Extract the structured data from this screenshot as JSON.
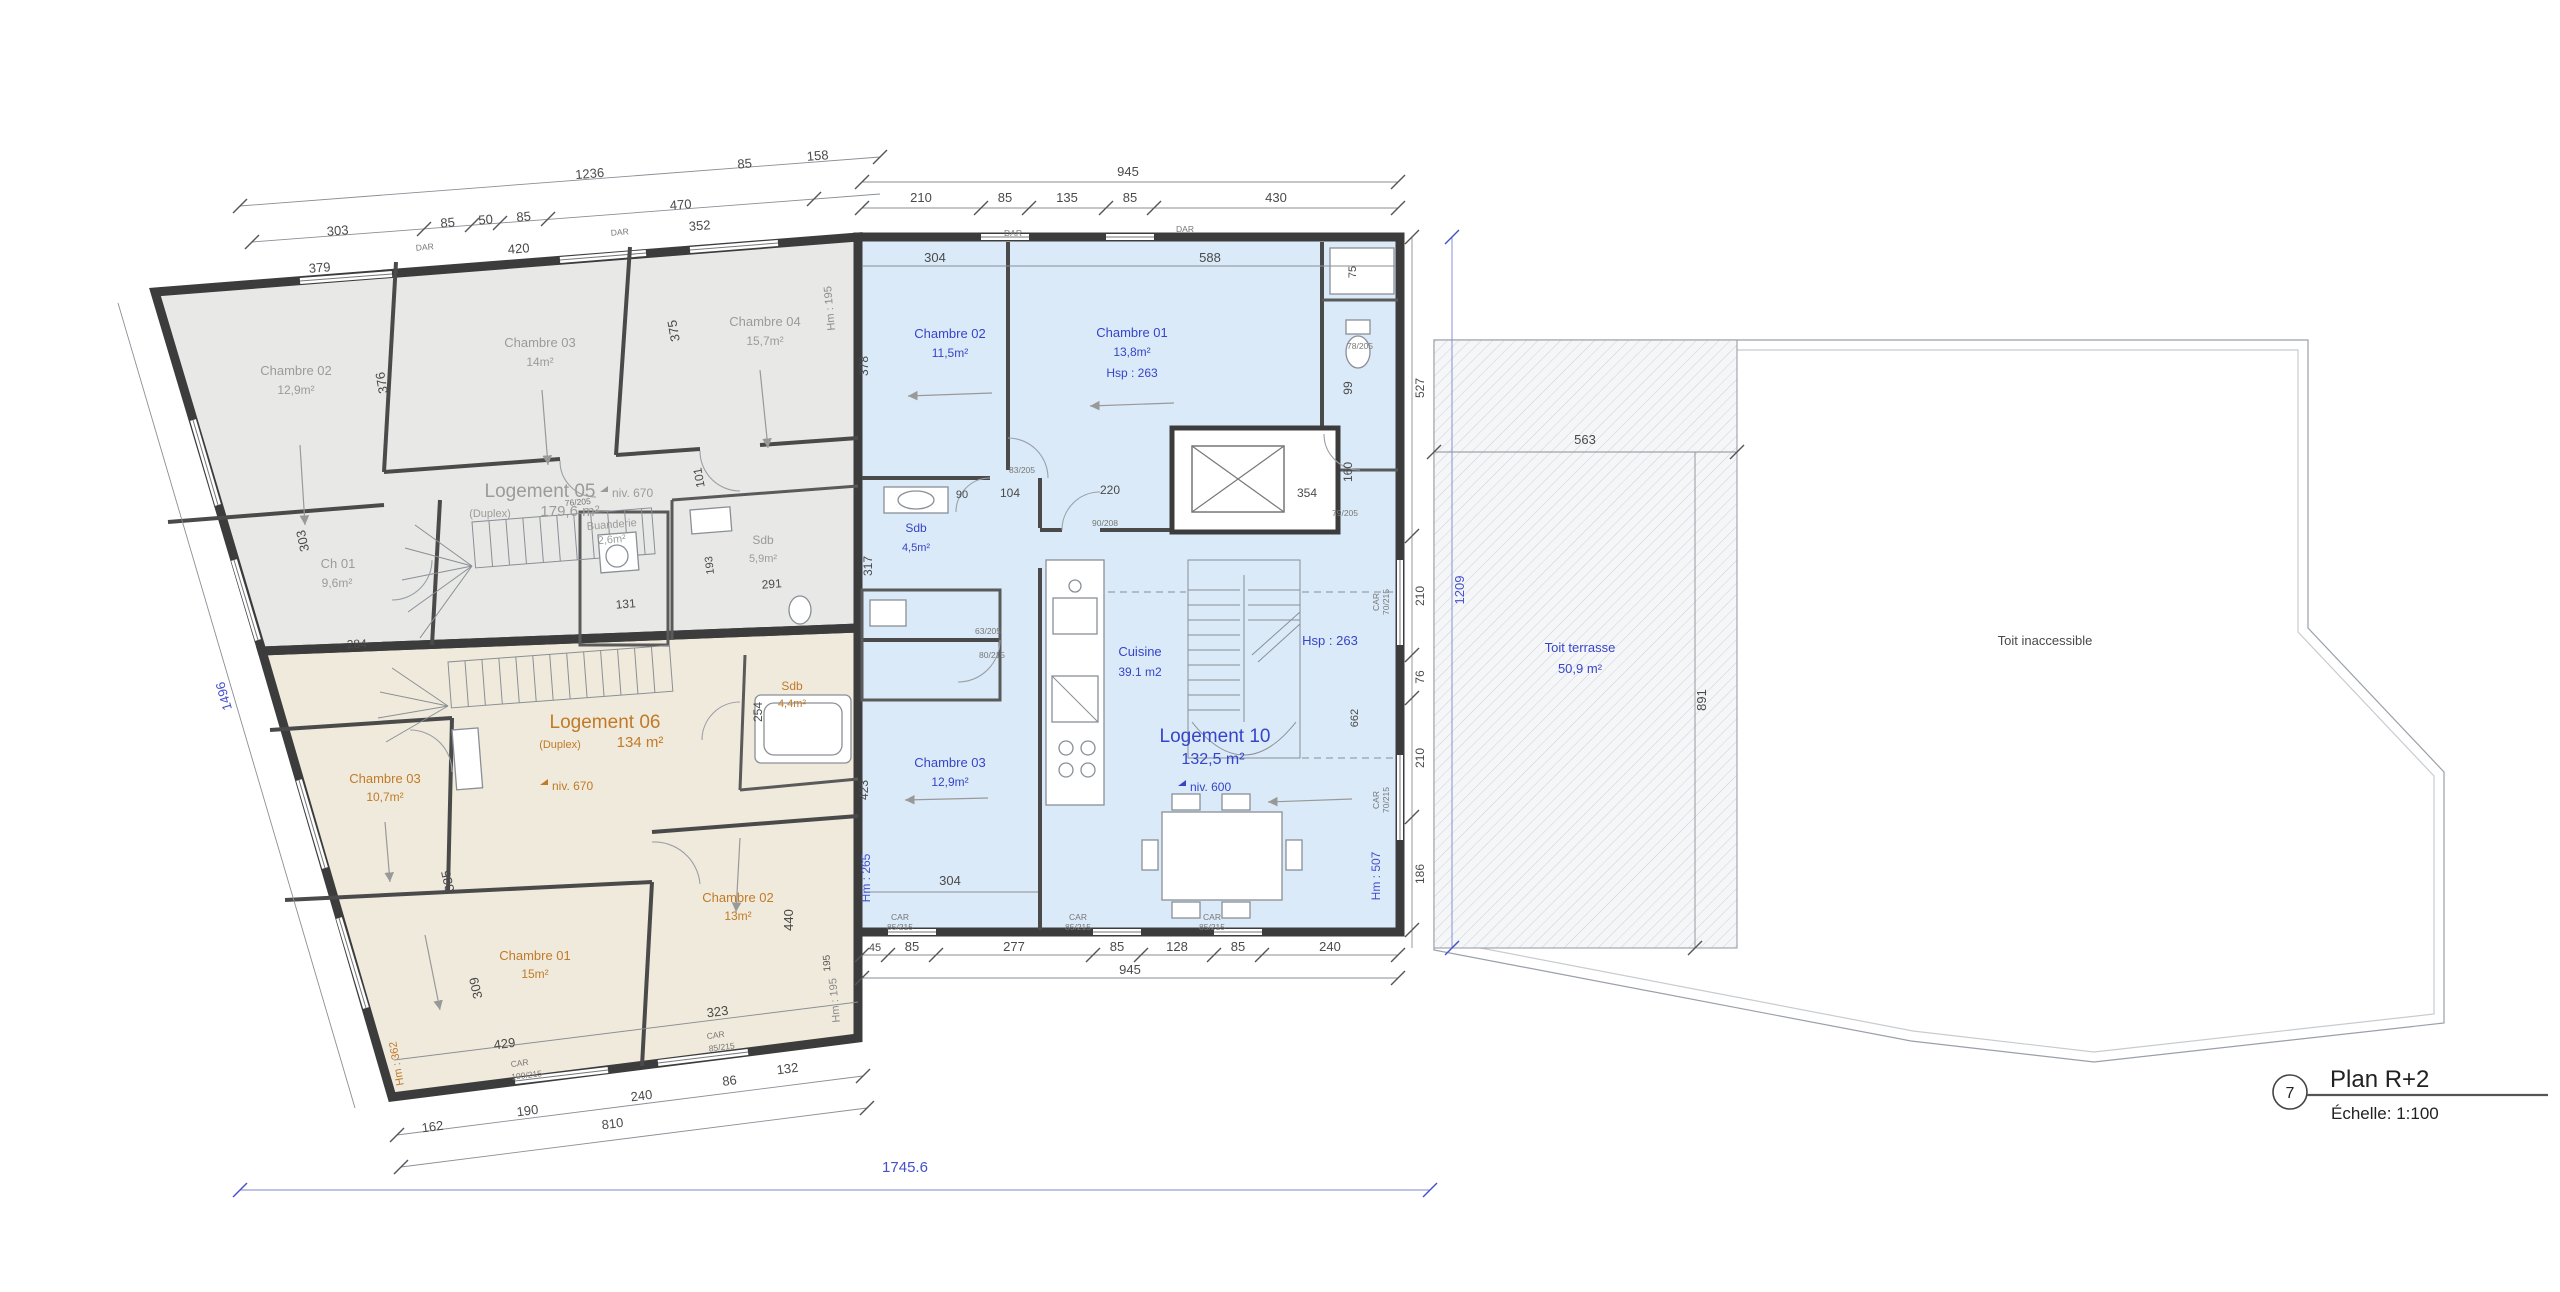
{
  "plan": {
    "number": "7",
    "title": "Plan R+2",
    "scale": "Échelle: 1:100"
  },
  "logement05": {
    "name": "Logement 05",
    "type": "(Duplex)",
    "area": "179,6 m²",
    "niv": "niv.  670",
    "ch02_name": "Chambre 02",
    "ch02_area": "12,9m²",
    "ch03_name": "Chambre 03",
    "ch03_area": "14m²",
    "ch04_name": "Chambre 04",
    "ch04_area": "15,7m²",
    "ch01_name": "Ch 01",
    "ch01_area": "9,6m²",
    "buanderie_name": "Buanderie",
    "buanderie_area": "2,6m²",
    "sdb_name": "Sdb",
    "sdb_area": "5,9m²"
  },
  "logement06": {
    "name": "Logement 06",
    "type": "(Duplex)",
    "area": "134 m²",
    "niv": "niv.  670",
    "ch03_name": "Chambre 03",
    "ch03_area": "10,7m²",
    "ch01_name": "Chambre 01",
    "ch01_area": "15m²",
    "ch02_name": "Chambre 02",
    "ch02_area": "13m²",
    "sdb_name": "Sdb",
    "sdb_area": "4,4m²"
  },
  "logement10": {
    "name": "Logement 10",
    "area": "132,5 m²",
    "niv": "niv.  600",
    "hsp": "Hsp : 263",
    "ch02_name": "Chambre 02",
    "ch02_area": "11,5m²",
    "ch01_name": "Chambre 01",
    "ch01_area": "13,8m²",
    "ch01_hsp": "Hsp : 263",
    "sdb_name": "Sdb",
    "sdb_area": "4,5m²",
    "ch03_name": "Chambre 03",
    "ch03_area": "12,9m²",
    "cuisine_name": "Cuisine",
    "cuisine_area": "39.1 m2"
  },
  "roof": {
    "terrace_name": "Toit terrasse",
    "terrace_area": "50,9 m²",
    "inaccessible": "Toit inaccessible"
  },
  "dims": {
    "overall": "1745.6",
    "gray_top1": [
      "1236",
      "85",
      "158"
    ],
    "gray_top2": [
      "303",
      "85",
      "50",
      "85",
      "470",
      "352"
    ],
    "gray_inner": {
      "a379": "379",
      "a420": "420",
      "a375": "375",
      "a376": "376",
      "a101": "101",
      "a131": "131",
      "a284": "284",
      "a291": "291",
      "a193": "193",
      "a303": "303"
    },
    "gray_left": "1496",
    "gray_hm": "Hm : 195",
    "blue_top_total": "945",
    "blue_top": [
      "210",
      "85",
      "135",
      "85",
      "430"
    ],
    "blue_top_inner": [
      "304",
      "588",
      "75"
    ],
    "blue_left": {
      "a378": "378",
      "a317": "317",
      "a423": "423",
      "a304": "304"
    },
    "blue_left_hm": "Hm : 265",
    "blue_inner": {
      "a90": "90",
      "a104": "104",
      "a220": "220",
      "a354": "354",
      "a160": "160",
      "a99": "99",
      "a662": "662"
    },
    "blue_right": {
      "a527": "527",
      "a210a": "210",
      "a76": "76",
      "a210b": "210",
      "a186": "186"
    },
    "blue_right_total": "1209",
    "blue_right_hm": "Hm : 507",
    "blue_bottom": [
      "45",
      "85",
      "277",
      "85",
      "128",
      "85",
      "240"
    ],
    "blue_bottom_total": "945",
    "terrace_w": "563",
    "terrace_h": "891",
    "beige_inner": {
      "a335": "335",
      "a309": "309",
      "a429": "429",
      "a323": "323",
      "a440": "440",
      "a254": "254",
      "a195": "195"
    },
    "beige_bottom": [
      "162",
      "190",
      "810",
      "240",
      "86",
      "132"
    ],
    "beige_hm_right": "Hm : 195",
    "beige_hm_left": "Hm : 362"
  },
  "tags": {
    "dar": "DAR",
    "car": "CAR",
    "w85": "85/215",
    "w70": "70/215",
    "w100": "100/215",
    "d76": "76/205",
    "d78": "78/205",
    "d79": "79/205",
    "d83": "83/205",
    "d90": "90/208",
    "d63": "63/205",
    "d80": "80/215"
  }
}
